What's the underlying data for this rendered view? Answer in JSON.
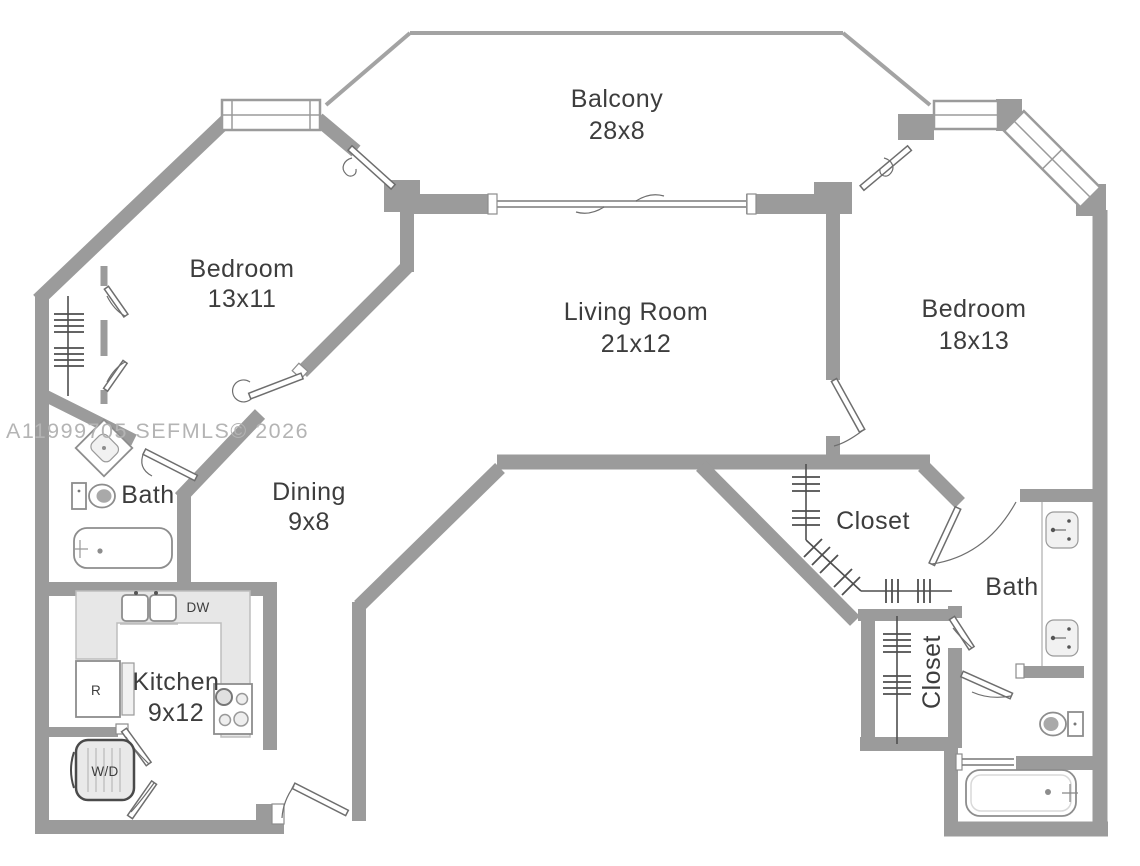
{
  "plan": {
    "watermark": "A11999705  SEFMLS© 2026",
    "rooms": {
      "balcony": {
        "label": "Balcony",
        "dims": "28x8"
      },
      "bedroom1": {
        "label": "Bedroom",
        "dims": "13x11"
      },
      "living": {
        "label": "Living Room",
        "dims": "21x12"
      },
      "bedroom2": {
        "label": "Bedroom",
        "dims": "18x13"
      },
      "bath1": {
        "label": "Bath"
      },
      "dining": {
        "label": "Dining",
        "dims": "9x8"
      },
      "kitchen": {
        "label": "Kitchen",
        "dims": "9x12"
      },
      "closet1": {
        "label": "Closet"
      },
      "bath2": {
        "label": "Bath"
      },
      "closet2": {
        "label": "Closet"
      }
    },
    "appliances": {
      "dishwasher": "DW",
      "refrigerator": "R",
      "washer_dryer": "W/D"
    },
    "colors": {
      "wall": "#9b9b9b",
      "background": "#ffffff",
      "text": "#3d3d3d",
      "watermark": "#b4b4b4",
      "fixture_outline": "#8d8d8d",
      "counter_fill": "#e7e7e7"
    }
  }
}
